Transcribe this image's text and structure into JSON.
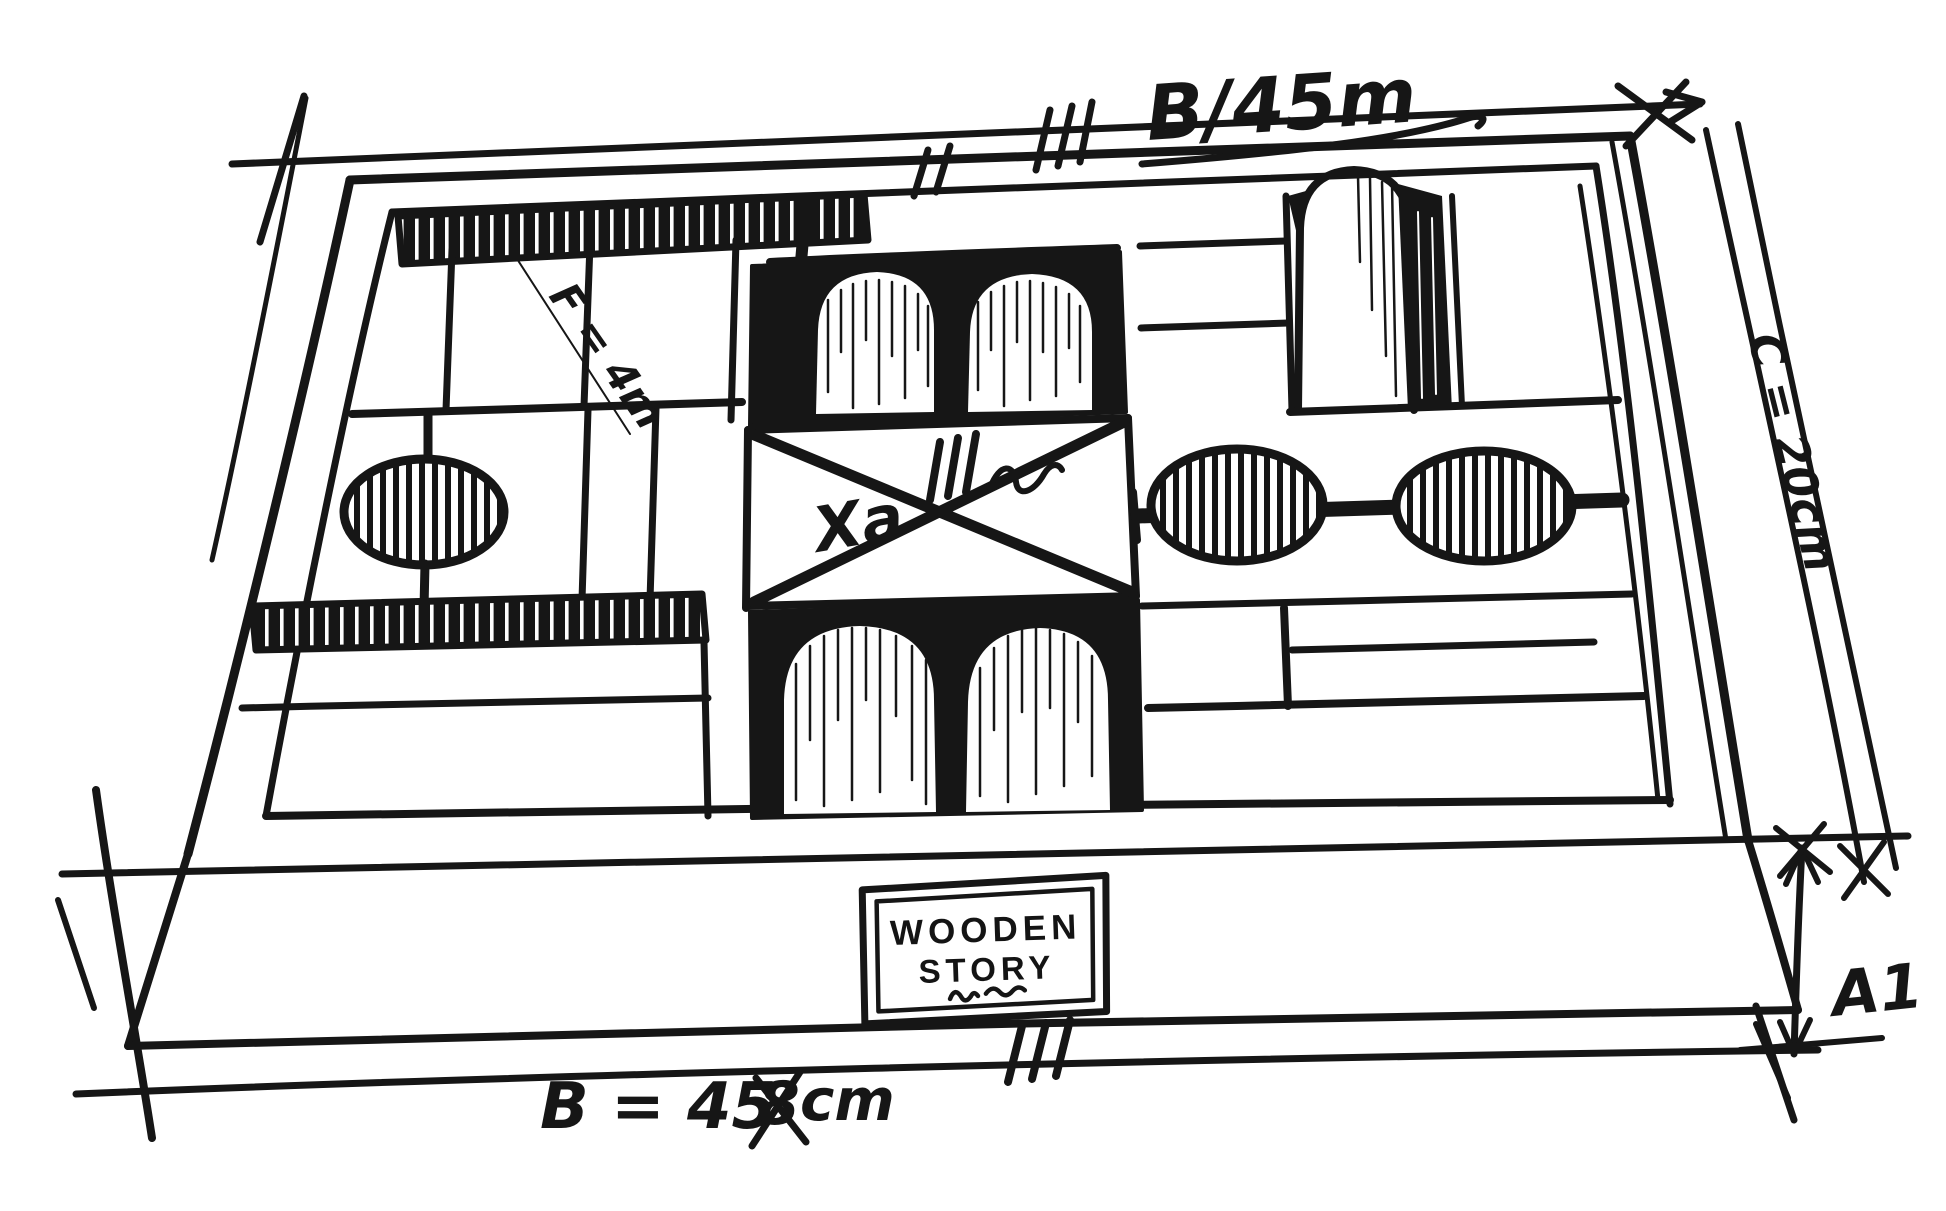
{
  "page": {
    "paper_color": "#ffffff",
    "ink_color": "#161616"
  },
  "sketch": {
    "subject": "wooden blocks tray perspective sketch"
  },
  "annotations": {
    "top_width": "B/45m",
    "right_depth": "C = 20cm",
    "bottom_width_prefix": "B = 45",
    "bottom_width_struck": "8",
    "bottom_width_suffix": "cm",
    "front_height": "A1",
    "block_diagonal": "F = 4m",
    "center_block": "Xa"
  },
  "brand_label": {
    "line1": "WOODEN",
    "line2": "STORY"
  }
}
